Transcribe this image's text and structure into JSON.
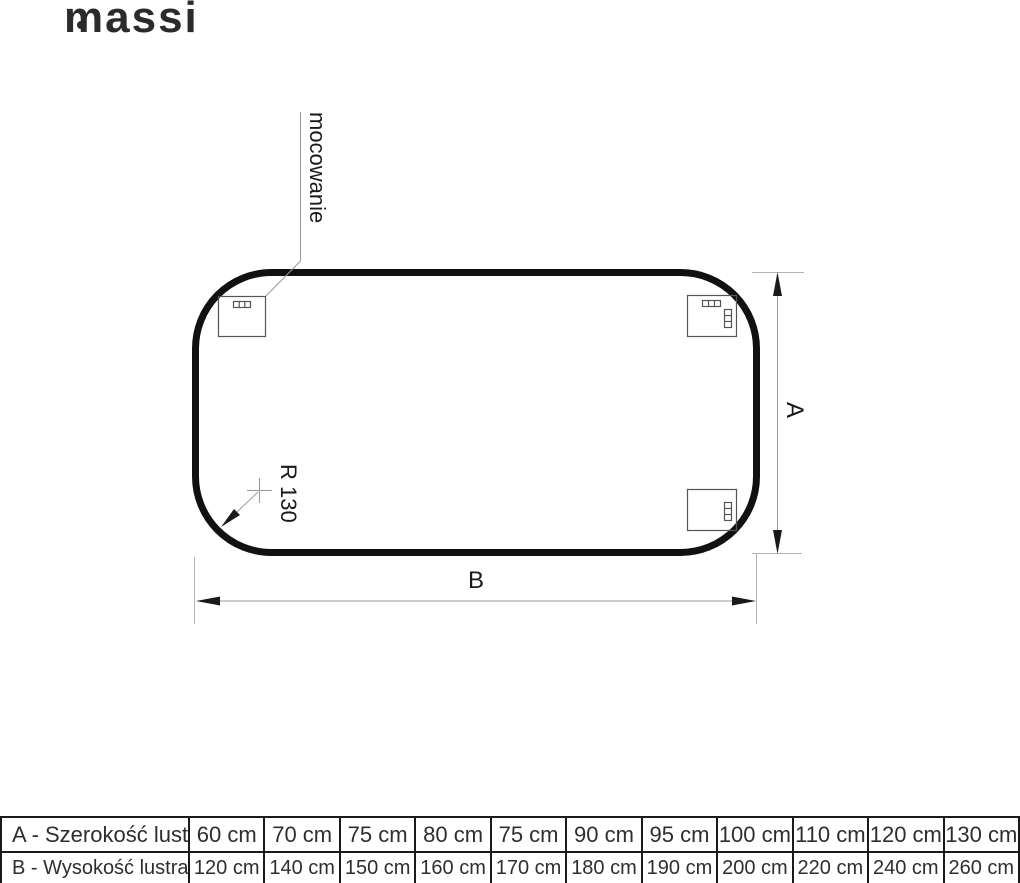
{
  "logo": {
    "text": "massi"
  },
  "diagram": {
    "labels": {
      "mounting": "mocowanie",
      "radius": "R 130",
      "dim_a": "A",
      "dim_b": "B"
    }
  },
  "table": {
    "rows": [
      {
        "label": "A - Szerokość lustra",
        "values": [
          "60 cm",
          "70 cm",
          "75 cm",
          "80 cm",
          "75 cm",
          "90 cm",
          "95 cm",
          "100 cm",
          "110 cm",
          "120 cm",
          "130 cm"
        ]
      },
      {
        "label": "B - Wysokość lustra",
        "values": [
          "120 cm",
          "140 cm",
          "150 cm",
          "160 cm",
          "170 cm",
          "180 cm",
          "190 cm",
          "200 cm",
          "220 cm",
          "240 cm",
          "260 cm"
        ]
      }
    ]
  },
  "colors": {
    "background": "#ffffff",
    "outline": "#111111",
    "dimension_line": "#9b9b9b",
    "extension_line": "#b3b3b3",
    "text": "#1a1a1a"
  }
}
